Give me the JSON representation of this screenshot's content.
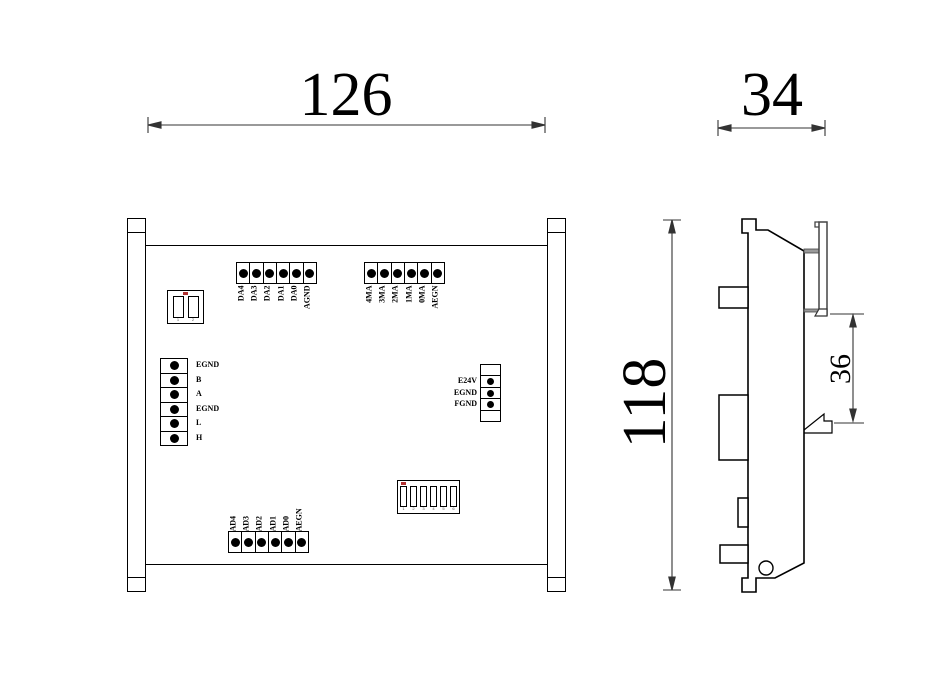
{
  "dimensions": {
    "front_width": "126",
    "front_height": "118",
    "side_width": "34",
    "rail_height": "36"
  },
  "front": {
    "da_block": [
      "DA4",
      "DA3",
      "DA2",
      "DA1",
      "DA0",
      "AGND"
    ],
    "ma_block": [
      "4MA",
      "3MA",
      "2MA",
      "1MA",
      "0MA",
      "AEGN"
    ],
    "comm_block": [
      "EGND",
      "B",
      "A",
      "EGND",
      "L",
      "H"
    ],
    "power_block": [
      "E24V",
      "EGND",
      "FGND"
    ],
    "ad_block": [
      "AD4",
      "AD3",
      "AD2",
      "AD1",
      "AD0",
      "AEGN"
    ],
    "dip2": {
      "numbers": [
        "1",
        "2"
      ]
    },
    "dip6": {
      "numbers": [
        "1",
        "2",
        "3",
        "4",
        "5",
        "6"
      ]
    }
  },
  "colors": {
    "line": "#000000",
    "background": "#ffffff",
    "gray": "#999999"
  }
}
